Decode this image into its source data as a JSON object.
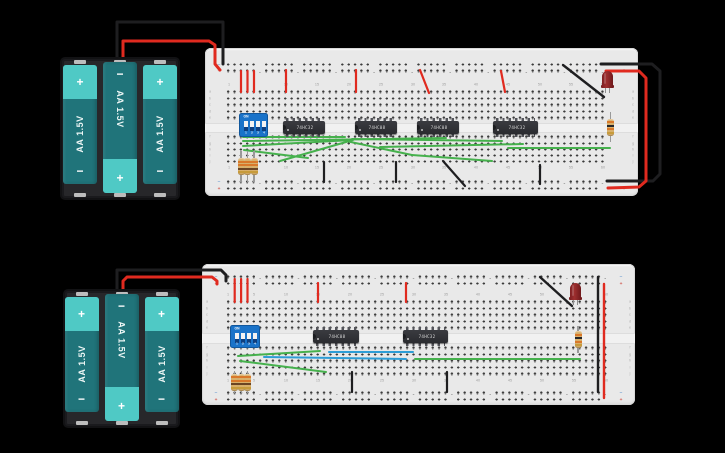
{
  "scene": {
    "width": 725,
    "height": 453,
    "background": "#000000"
  },
  "signs": {
    "plus": "+",
    "minus": "−"
  },
  "colors": {
    "board": "#e9e9e9",
    "hole": "#3b3b3b",
    "wire_red": "#e02a1f",
    "wire_black": "#1e1e20",
    "wire_green": "#46b14d",
    "wire_blue": "#2d9dd6",
    "battery_body": "#20747a",
    "battery_cap": "#4fc9c5",
    "dip_blue": "#1a73c9",
    "ic_body": "#313237",
    "resistor_body": "#d9b06a",
    "led_red": "#8c2327"
  },
  "battery_packs": [
    {
      "x": 60,
      "y": 57,
      "w": 120,
      "h": 143,
      "cells": [
        {
          "label": "AA 1.5V",
          "flipped": false
        },
        {
          "label": "AA 1.5V",
          "flipped": true
        },
        {
          "label": "AA 1.5V",
          "flipped": false
        }
      ]
    },
    {
      "x": 63,
      "y": 289,
      "w": 117,
      "h": 139,
      "cells": [
        {
          "label": "AA 1.5V",
          "flipped": false
        },
        {
          "label": "AA 1.5V",
          "flipped": true
        },
        {
          "label": "AA 1.5V",
          "flipped": false
        }
      ]
    }
  ],
  "breadboards": [
    {
      "x": 205,
      "y": 48,
      "w": 433,
      "h": 148,
      "col1": 23.5,
      "col_spacing": 6.35,
      "rows": {
        "rail1": 16.5,
        "rail2": 23,
        "num1": 36.5,
        "a": 44,
        "b": 50.5,
        "c": 57,
        "d": 63.5,
        "e": 70,
        "f": 89,
        "g": 95.5,
        "h": 101.5,
        "i": 107.5,
        "j": 113.5,
        "num2": 120,
        "rail3": 134,
        "rail4": 140.5
      },
      "column_labels": [
        "1",
        "5",
        "10",
        "15",
        "20",
        "25",
        "30",
        "35",
        "40",
        "45",
        "50",
        "55",
        "60"
      ],
      "row_letters": [
        "a",
        "b",
        "c",
        "d",
        "e",
        "f",
        "g",
        "h",
        "i",
        "j"
      ]
    },
    {
      "x": 202,
      "y": 264,
      "w": 433,
      "h": 141,
      "col1": 26.3,
      "col_spacing": 6.4,
      "rows": {
        "rail1": 13,
        "rail2": 19.5,
        "num1": 31,
        "a": 38,
        "b": 44.5,
        "c": 51,
        "d": 57.5,
        "e": 64,
        "f": 84,
        "g": 90.5,
        "h": 97,
        "i": 103.5,
        "j": 110,
        "num2": 117,
        "rail3": 129,
        "rail4": 135.5
      },
      "column_labels": [
        "1",
        "5",
        "10",
        "15",
        "20",
        "25",
        "30",
        "35",
        "40",
        "45",
        "50",
        "55",
        "60"
      ],
      "row_letters": [
        "a",
        "b",
        "c",
        "d",
        "e",
        "f",
        "g",
        "h",
        "i",
        "j"
      ]
    }
  ],
  "ics": [
    {
      "x": 283,
      "y": 121,
      "w": 42,
      "label": "74HC32"
    },
    {
      "x": 355,
      "y": 121,
      "w": 42,
      "label": "74HC08"
    },
    {
      "x": 417,
      "y": 121,
      "w": 42,
      "label": "74HC08"
    },
    {
      "x": 493,
      "y": 121,
      "w": 45,
      "label": "74HC32"
    },
    {
      "x": 313,
      "y": 330,
      "w": 46,
      "label": "74HC08"
    },
    {
      "x": 403,
      "y": 330,
      "w": 45,
      "label": "74HC32"
    }
  ],
  "dip_switches": [
    {
      "x": 240,
      "y": 114,
      "w": 27,
      "h": 22,
      "on_label": "ON",
      "pin_labels": [
        "1",
        "2",
        "3",
        "4"
      ]
    },
    {
      "x": 231,
      "y": 326,
      "w": 28,
      "h": 21,
      "on_label": "ON",
      "pin_labels": [
        "1",
        "2",
        "3",
        "4"
      ]
    }
  ],
  "resistors": [
    {
      "cx": 241,
      "top": 151,
      "len": 31,
      "bands": [
        "#d9782a",
        "#d9782a",
        "#6b4423",
        "#c79b3b"
      ]
    },
    {
      "cx": 247.5,
      "top": 151,
      "len": 31,
      "bands": [
        "#d9782a",
        "#d9782a",
        "#6b4423",
        "#c79b3b"
      ]
    },
    {
      "cx": 254,
      "top": 151,
      "len": 31,
      "bands": [
        "#d9782a",
        "#d9782a",
        "#6b4423",
        "#c79b3b"
      ]
    },
    {
      "cx": 610.5,
      "top": 112,
      "len": 30,
      "bands": [
        "#d9782a",
        "#26262a",
        "#d9782a",
        "#c79b3b"
      ]
    },
    {
      "cx": 234.7,
      "top": 371,
      "len": 22,
      "bands": [
        "#d9782a",
        "#d9782a",
        "#6b4423",
        "#c79b3b"
      ]
    },
    {
      "cx": 241.1,
      "top": 371,
      "len": 22,
      "bands": [
        "#d9782a",
        "#d9782a",
        "#6b4423",
        "#c79b3b"
      ]
    },
    {
      "cx": 247.5,
      "top": 371,
      "len": 22,
      "bands": [
        "#d9782a",
        "#d9782a",
        "#6b4423",
        "#c79b3b"
      ]
    },
    {
      "cx": 578,
      "top": 326,
      "len": 27,
      "bands": [
        "#d9782a",
        "#26262a",
        "#d9782a",
        "#c79b3b"
      ]
    }
  ],
  "leds": [
    {
      "x": 602,
      "y": 71,
      "w": 11,
      "h": 17
    },
    {
      "x": 570,
      "y": 283,
      "w": 11,
      "h": 17
    }
  ],
  "wires": [
    {
      "color": "black",
      "w": 3,
      "pts": [
        [
          117,
          58
        ],
        [
          117,
          22
        ],
        [
          223,
          22
        ],
        [
          223,
          64
        ]
      ]
    },
    {
      "color": "red",
      "w": 3,
      "pts": [
        [
          123,
          58
        ],
        [
          123,
          41
        ],
        [
          209,
          41
        ],
        [
          215,
          45
        ],
        [
          215,
          64
        ],
        [
          220,
          70
        ]
      ]
    },
    {
      "color": "red",
      "w": 2.2,
      "pts": [
        [
          241,
          71
        ],
        [
          241,
          92
        ]
      ]
    },
    {
      "color": "red",
      "w": 2.2,
      "pts": [
        [
          247.5,
          71
        ],
        [
          247.5,
          92
        ]
      ]
    },
    {
      "color": "red",
      "w": 2.2,
      "pts": [
        [
          254,
          71
        ],
        [
          254,
          92
        ]
      ]
    },
    {
      "color": "red",
      "w": 2.2,
      "pts": [
        [
          286,
          70
        ],
        [
          286,
          92
        ]
      ]
    },
    {
      "color": "red",
      "w": 2.2,
      "pts": [
        [
          356,
          70
        ],
        [
          356,
          92
        ]
      ]
    },
    {
      "color": "red",
      "w": 2.2,
      "pts": [
        [
          420,
          70
        ],
        [
          429,
          93
        ]
      ]
    },
    {
      "color": "red",
      "w": 2.2,
      "pts": [
        [
          501,
          71
        ],
        [
          505,
          92
        ]
      ]
    },
    {
      "color": "black",
      "w": 2.4,
      "pts": [
        [
          563,
          65
        ],
        [
          604,
          97
        ]
      ]
    },
    {
      "color": "black",
      "w": 3,
      "pts": [
        [
          601,
          64
        ],
        [
          652,
          64
        ],
        [
          660,
          71
        ],
        [
          660,
          174
        ],
        [
          653,
          181
        ],
        [
          607,
          181
        ]
      ]
    },
    {
      "color": "red",
      "w": 3,
      "pts": [
        [
          606,
          71
        ],
        [
          639,
          71
        ],
        [
          646,
          78
        ],
        [
          646,
          181
        ],
        [
          639,
          187
        ],
        [
          608,
          188
        ]
      ]
    },
    {
      "color": "green",
      "w": 2,
      "pts": [
        [
          243,
          137
        ],
        [
          345,
          137
        ]
      ]
    },
    {
      "color": "green",
      "w": 2,
      "pts": [
        [
          243,
          141
        ],
        [
          446,
          138
        ]
      ]
    },
    {
      "color": "green",
      "w": 2,
      "pts": [
        [
          243,
          146
        ],
        [
          352,
          140
        ]
      ]
    },
    {
      "color": "green",
      "w": 2,
      "pts": [
        [
          244,
          150
        ],
        [
          308,
          158
        ]
      ]
    },
    {
      "color": "green",
      "w": 2,
      "pts": [
        [
          280,
          161
        ],
        [
          353,
          140
        ]
      ]
    },
    {
      "color": "green",
      "w": 2,
      "pts": [
        [
          346,
          141
        ],
        [
          412,
          155
        ]
      ]
    },
    {
      "color": "green",
      "w": 2,
      "pts": [
        [
          352,
          139
        ],
        [
          502,
          141
        ]
      ]
    },
    {
      "color": "green",
      "w": 2,
      "pts": [
        [
          380,
          147
        ],
        [
          523,
          144
        ]
      ]
    },
    {
      "color": "green",
      "w": 2,
      "pts": [
        [
          412,
          155
        ],
        [
          492,
          161
        ]
      ]
    },
    {
      "color": "green",
      "w": 2,
      "pts": [
        [
          508,
          148
        ],
        [
          610,
          148
        ]
      ]
    },
    {
      "color": "black",
      "w": 2.2,
      "pts": [
        [
          324,
          162
        ],
        [
          324,
          182
        ]
      ]
    },
    {
      "color": "black",
      "w": 2.2,
      "pts": [
        [
          396,
          162
        ],
        [
          396,
          182
        ]
      ]
    },
    {
      "color": "black",
      "w": 2.2,
      "pts": [
        [
          443,
          161
        ],
        [
          465,
          186
        ]
      ]
    },
    {
      "color": "black",
      "w": 2.2,
      "pts": [
        [
          540,
          165
        ],
        [
          540,
          184
        ]
      ]
    },
    {
      "color": "black",
      "w": 3,
      "pts": [
        [
          117,
          291
        ],
        [
          117,
          270
        ],
        [
          221,
          270
        ],
        [
          226,
          275
        ],
        [
          226,
          281
        ]
      ]
    },
    {
      "color": "red",
      "w": 3,
      "pts": [
        [
          123,
          291
        ],
        [
          123,
          281
        ],
        [
          127,
          277
        ],
        [
          212,
          277
        ],
        [
          217,
          281
        ],
        [
          217,
          284
        ]
      ]
    },
    {
      "color": "red",
      "w": 2.2,
      "pts": [
        [
          234.7,
          279
        ],
        [
          234.7,
          302
        ]
      ]
    },
    {
      "color": "red",
      "w": 2.2,
      "pts": [
        [
          241.1,
          279
        ],
        [
          241.1,
          302
        ]
      ]
    },
    {
      "color": "red",
      "w": 2.2,
      "pts": [
        [
          247.5,
          279
        ],
        [
          247.5,
          302
        ]
      ]
    },
    {
      "color": "red",
      "w": 2.2,
      "pts": [
        [
          318,
          283
        ],
        [
          318,
          302
        ]
      ]
    },
    {
      "color": "red",
      "w": 2.2,
      "pts": [
        [
          406,
          283
        ],
        [
          406,
          302
        ]
      ]
    },
    {
      "color": "black",
      "w": 2.4,
      "pts": [
        [
          540,
          277
        ],
        [
          572,
          306
        ]
      ]
    },
    {
      "color": "black",
      "w": 2.4,
      "pts": [
        [
          598,
          277
        ],
        [
          598,
          392
        ]
      ]
    },
    {
      "color": "red",
      "w": 2.4,
      "pts": [
        [
          604,
          284
        ],
        [
          604,
          398
        ]
      ]
    },
    {
      "color": "green",
      "w": 2,
      "pts": [
        [
          238,
          356
        ],
        [
          320,
          351
        ]
      ]
    },
    {
      "color": "blue",
      "w": 2,
      "pts": [
        [
          329,
          352
        ],
        [
          413,
          352
        ]
      ]
    },
    {
      "color": "blue",
      "w": 2,
      "pts": [
        [
          264,
          357
        ],
        [
          406,
          359
        ]
      ]
    },
    {
      "color": "green",
      "w": 2,
      "pts": [
        [
          240,
          361
        ],
        [
          326,
          372
        ]
      ]
    },
    {
      "color": "green",
      "w": 2,
      "pts": [
        [
          415,
          359
        ],
        [
          580,
          359
        ]
      ]
    },
    {
      "color": "black",
      "w": 2.2,
      "pts": [
        [
          352,
          372
        ],
        [
          352,
          392
        ]
      ]
    },
    {
      "color": "black",
      "w": 2.2,
      "pts": [
        [
          447,
          372
        ],
        [
          447,
          392
        ]
      ]
    }
  ]
}
